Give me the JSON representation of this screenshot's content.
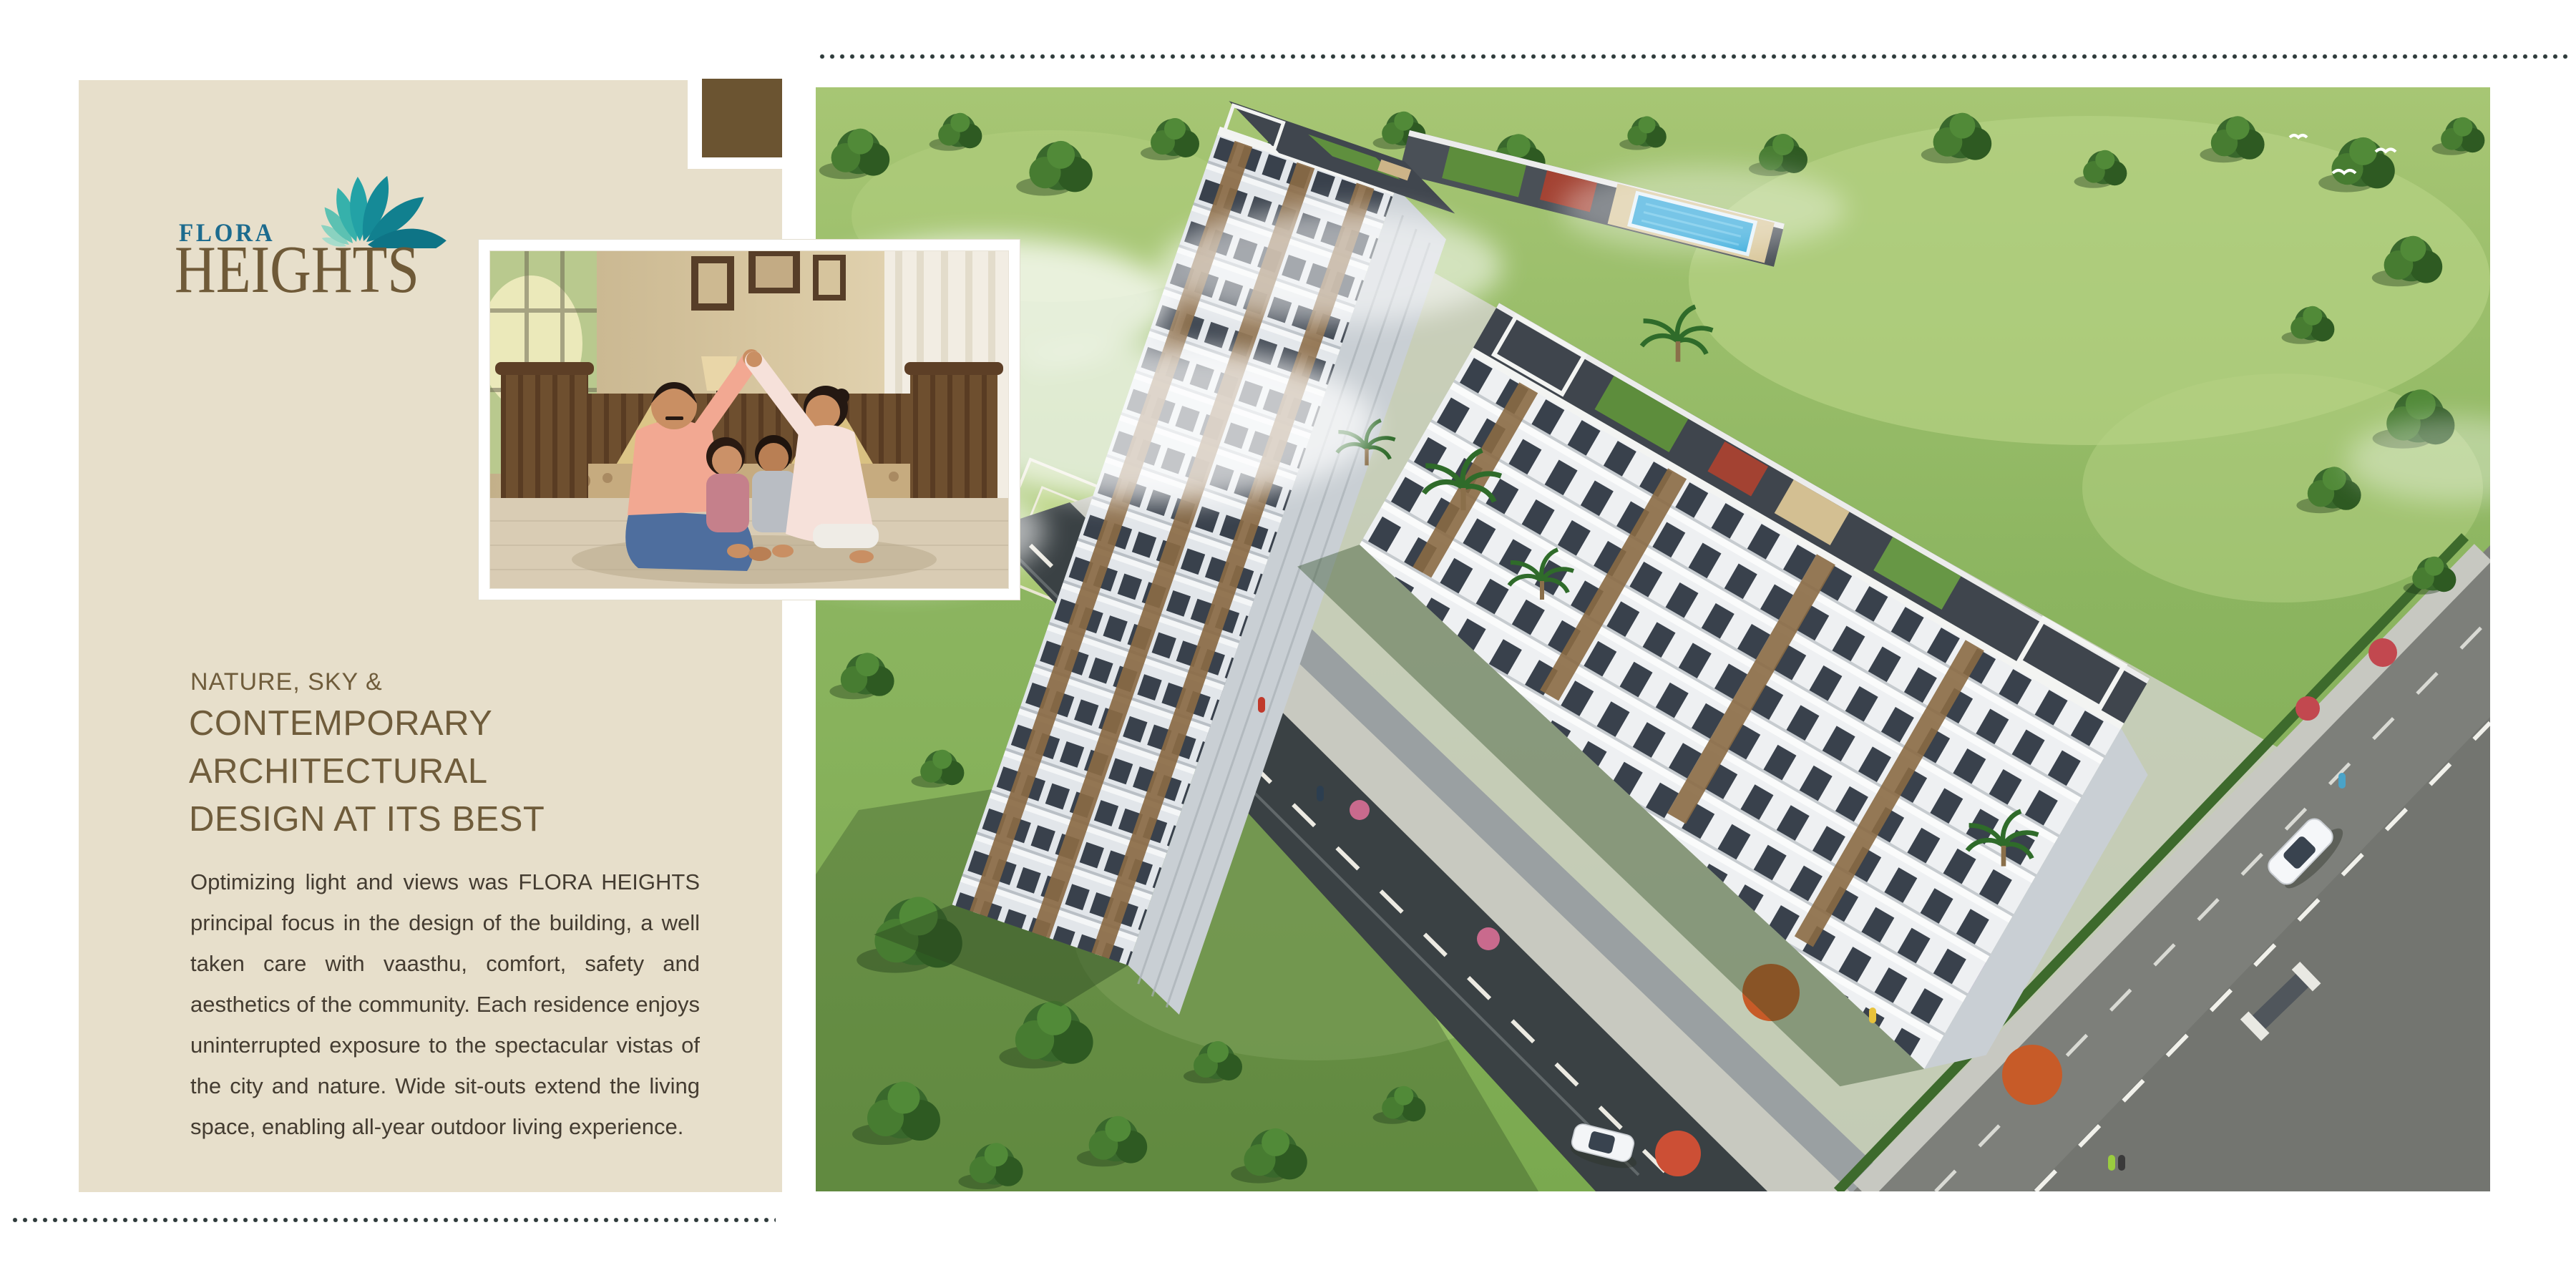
{
  "brand": {
    "name_top": "FLORA",
    "name_bottom": "HEIGHTS",
    "colors": {
      "flora_text": "#1c6b8e",
      "heights_text": "#6f5a38",
      "petals": [
        "#a8dccb",
        "#8ad2c0",
        "#5cc1b2",
        "#36b1ab",
        "#23a2a6",
        "#158a97",
        "#11808f",
        "#0e7486"
      ]
    }
  },
  "panel": {
    "background": "#e7dfcb",
    "accent_square_color": "#6b5431"
  },
  "headline": {
    "eyebrow": "NATURE, SKY &",
    "lines": [
      "CONTEMPORARY",
      "ARCHITECTURAL",
      "DESIGN AT ITS BEST"
    ],
    "color": "#6f5c3b"
  },
  "body_paragraph": {
    "text": "Optimizing light and views  was FLORA HEIGHTS principal focus in the design of the building, a well taken care with vaasthu, comfort, safety and aesthetics of the community. Each residence enjoys uninterrupted exposure to the spectacular vistas of the city and nature. Wide sit-outs extend the living space, enabling all-year outdoor living experience.",
    "color": "#443c31"
  },
  "images": {
    "family_photo": {
      "description": "Family of four sitting on a living room floor in front of a wooden sofa, parents' raised arms forming a roof shape over the children"
    },
    "aerial_render": {
      "description": "Aerial 3D render of the Flora Heights apartment towers with rooftop swimming pool, pergolas, terrace gardens, lawns, playground and tree-lined roads"
    }
  },
  "decor": {
    "page_background": "#ffffff",
    "dot_color": "#2e3a3a"
  }
}
